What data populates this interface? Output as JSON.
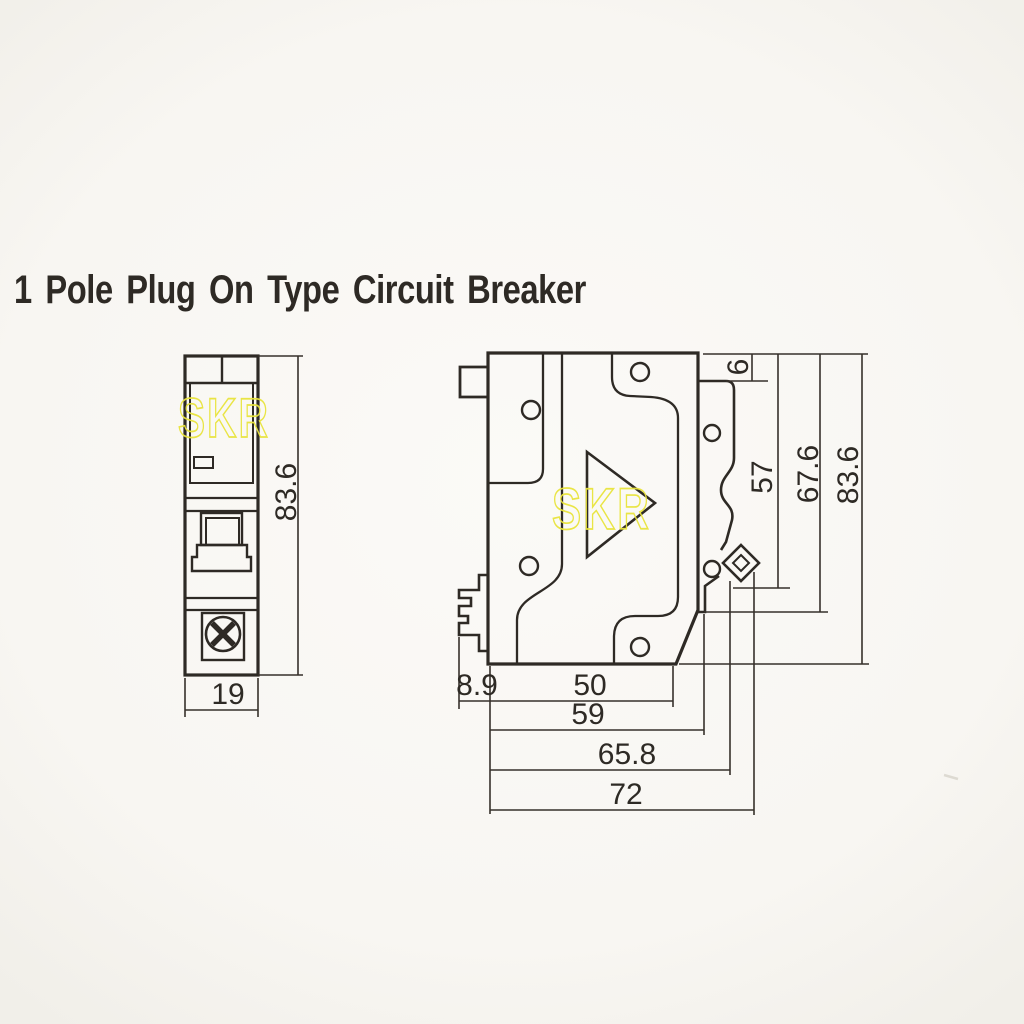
{
  "title": "1 Pole Plug On Type Circuit Breaker",
  "watermark": {
    "text": "SKR",
    "color": "#e9e43c"
  },
  "colors": {
    "ink": "#2e2a25",
    "paper": "#f8f6f2",
    "watermark_yellow": "#e9e43c"
  },
  "front_view": {
    "label": "front view",
    "height_dim": "83.6",
    "width_dim": "19"
  },
  "side_view": {
    "label": "side view",
    "top_offset_dim": "6",
    "height_dims": [
      "57",
      "67.6",
      "83.6"
    ],
    "width_dims": [
      "8.9",
      "50",
      "59",
      "65.8",
      "72"
    ]
  }
}
